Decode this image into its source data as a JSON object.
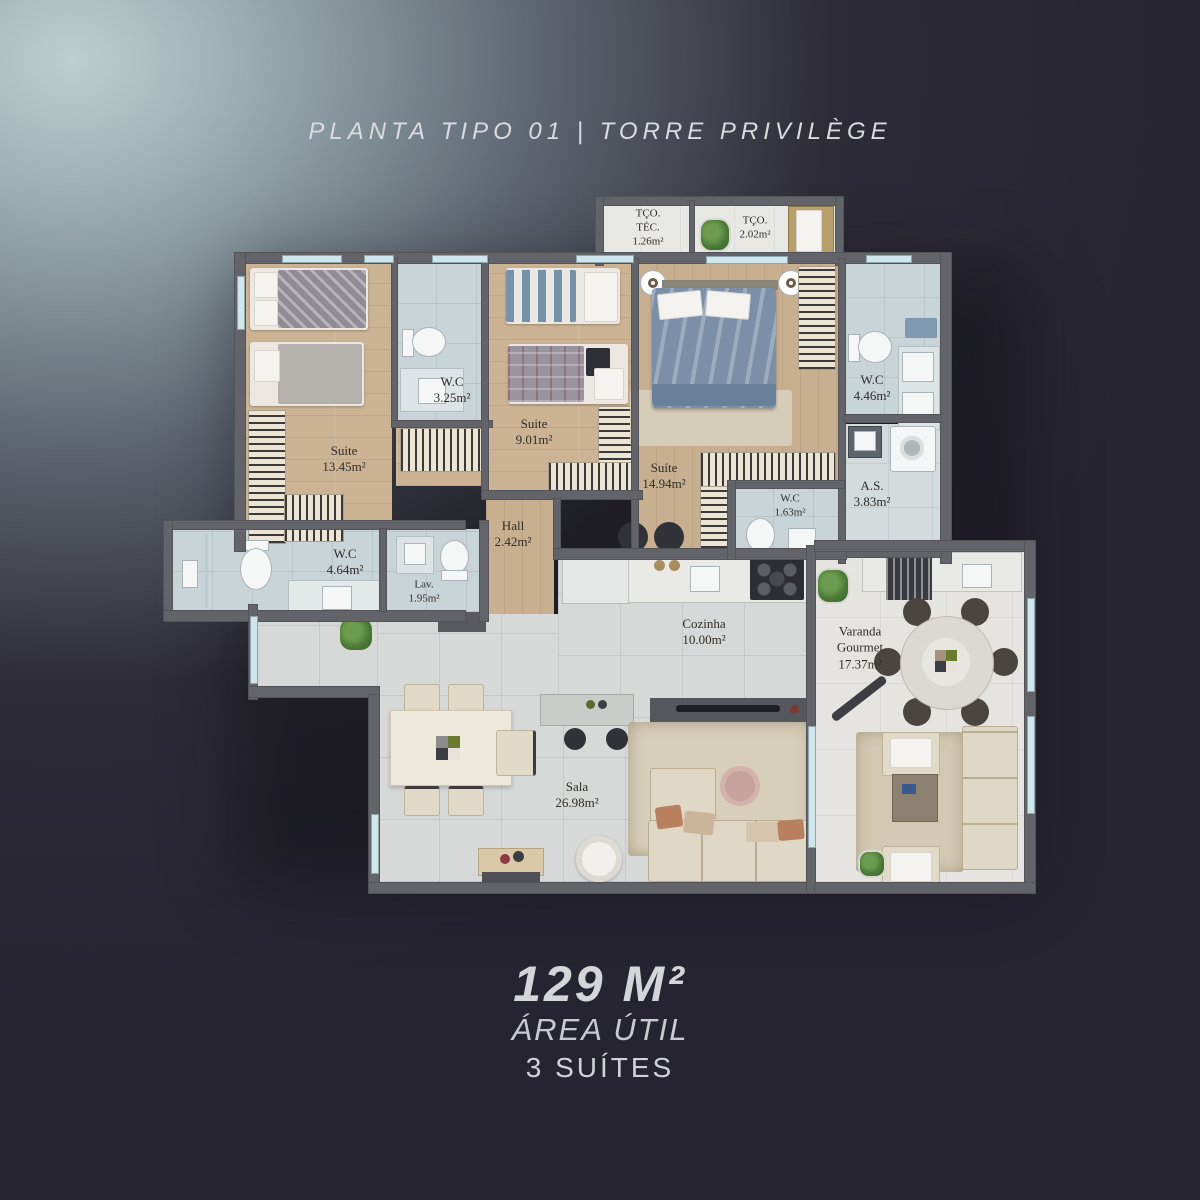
{
  "title": "PLANTA TIPO 01 | TORRE PRIVILÈGE",
  "summary": {
    "area": "129 M²",
    "area_label": "ÁREA ÚTIL",
    "suites": "3 SUÍTES"
  },
  "rooms": [
    {
      "key": "tco-tec",
      "name": "TÇO.\nTÉC.",
      "area": "1.26m²"
    },
    {
      "key": "tco",
      "name": "TÇO.",
      "area": "2.02m²"
    },
    {
      "key": "suite-1",
      "name": "Suite",
      "area": "13.45m²"
    },
    {
      "key": "wc-suite-1",
      "name": "W.C",
      "area": "3.25m²"
    },
    {
      "key": "suite-2",
      "name": "Suite",
      "area": "9.01m²"
    },
    {
      "key": "suite-3",
      "name": "Suíte",
      "area": "14.94m²"
    },
    {
      "key": "wc-suite-3",
      "name": "W.C",
      "area": "4.46m²"
    },
    {
      "key": "area-servico",
      "name": "A.S.",
      "area": "3.83m²"
    },
    {
      "key": "wc-suite-2",
      "name": "W.C",
      "area": "1.63m²"
    },
    {
      "key": "hall",
      "name": "Hall",
      "area": "2.42m²"
    },
    {
      "key": "wc-social",
      "name": "W.C",
      "area": "4.64m²"
    },
    {
      "key": "lavabo",
      "name": "Lav.",
      "area": "1.95m²"
    },
    {
      "key": "cozinha",
      "name": "Cozinha",
      "area": "10.00m²"
    },
    {
      "key": "varanda-gourmet",
      "name": "Varanda\nGourmet",
      "area": "17.37m²"
    },
    {
      "key": "sala",
      "name": "Sala",
      "area": "26.98m²"
    }
  ],
  "colors": {
    "background_dark": "#262430",
    "background_light": "#bccfd0",
    "wall": "#63646a",
    "wood_floor": "#cbb394",
    "bath_tile": "#c9d4d8",
    "living_tile": "#d6d9d7",
    "varanda_floor": "#e5e4e0",
    "window_glass": "#cfe7ec",
    "label_text": "#302c27",
    "heading_text": "#d3d5d9"
  }
}
